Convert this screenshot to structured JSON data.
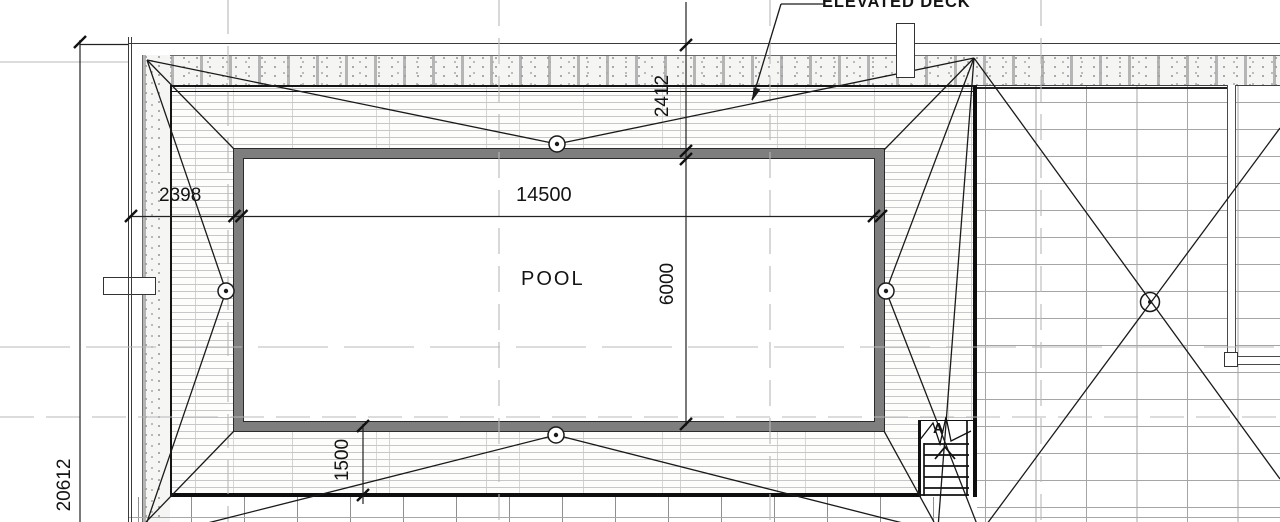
{
  "drawing": {
    "labels": {
      "elevated_deck": "ELEVATED DECK",
      "pool": "POOL",
      "stair_section": "A"
    },
    "dimensions": {
      "pool_length": "14500",
      "pool_width": "6000",
      "deck_offset_top": "2412",
      "deck_offset_left": "2398",
      "deck_offset_bottom": "1500",
      "site_length": "20612"
    },
    "colors": {
      "line": "#1a1a1a",
      "pool_wall": "#7e7e7e",
      "plank_line": "#c7c7c7",
      "paving_grid": "#a5a5a5",
      "centerline": "#b8b8b8",
      "stipple_dot": "#9e9e9e"
    }
  }
}
